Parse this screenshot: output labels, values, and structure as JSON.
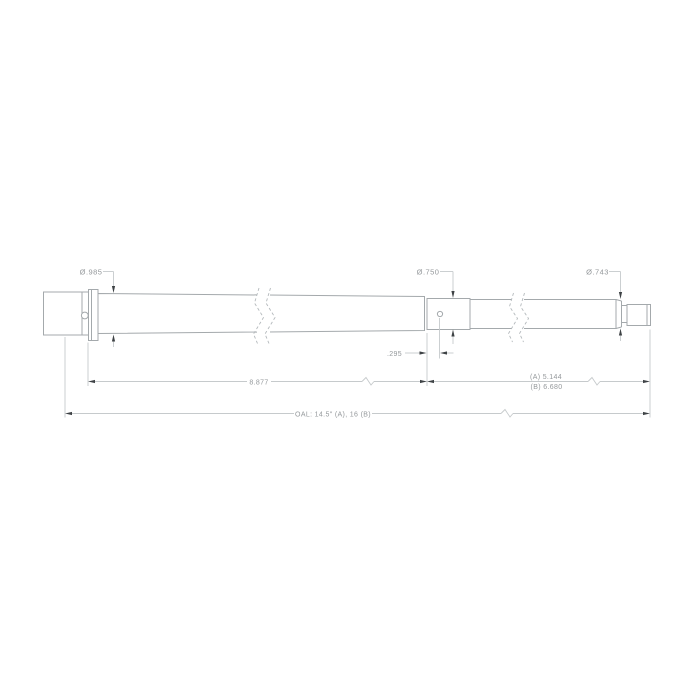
{
  "drawing": {
    "type": "technical-drawing",
    "subject": "barrel-profile-side-view",
    "colors": {
      "background": "#ffffff",
      "part_outline": "#a4a9ac",
      "dimension_line": "#c6cacc",
      "break_line": "#b4b9bc",
      "arrowhead": "#3e4245",
      "text": "#94989b"
    },
    "dimensions": {
      "dia_chamber": "Ø.985",
      "dia_gas_journal": "Ø.750",
      "dia_muzzle": "Ø.743",
      "gas_port_offset": ".295",
      "length_rear": "8.877",
      "length_front_a": "(A) 5.144",
      "length_front_b": "(B) 6.680",
      "overall_length": "OAL: 14.5\" (A), 16 (B)"
    }
  }
}
